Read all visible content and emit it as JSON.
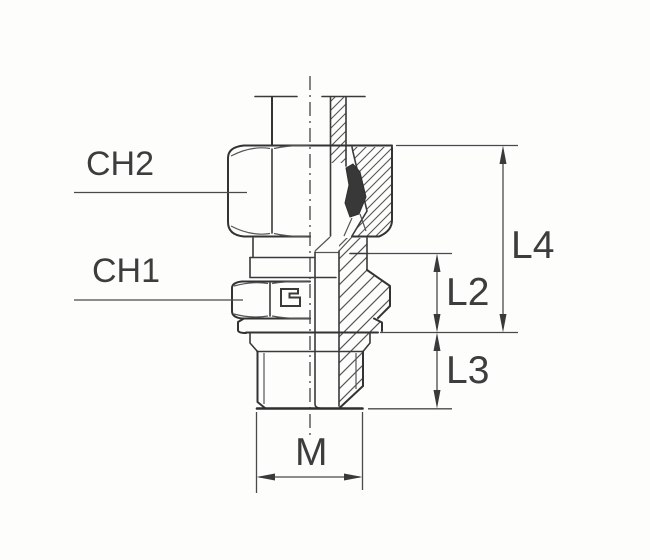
{
  "diagram": {
    "type": "technical-drawing",
    "subject": "male-stud-fitting-half-section",
    "labels": {
      "ch2": "CH2",
      "ch1": "CH1",
      "l4": "L4",
      "l2": "L2",
      "l3": "L3",
      "m": "M"
    },
    "colors": {
      "line": "#333333",
      "dimension": "#4a4a4a",
      "text": "#3d3d3d",
      "background": "#fdfdfc"
    }
  }
}
